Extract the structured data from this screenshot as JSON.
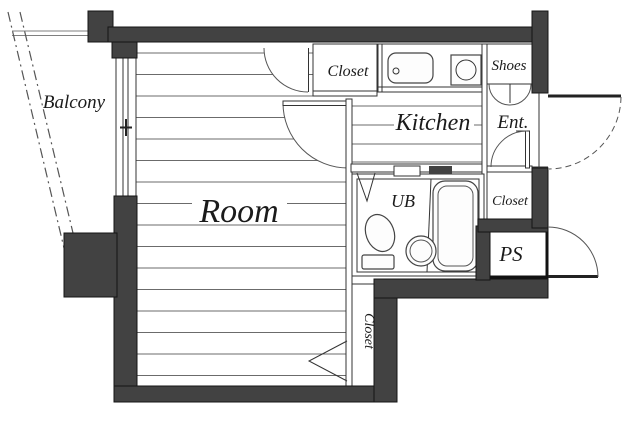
{
  "plan": {
    "type": "apartment-floor-plan",
    "labels": {
      "balcony": "Balcony",
      "room": "Room",
      "kitchen": "Kitchen",
      "closet_top": "Closet",
      "shoes": "Shoes",
      "entrance": "Ent.",
      "unit_bath": "UB",
      "closet_side": "Closet",
      "pipe_space": "PS",
      "closet_bottom": "Closet"
    },
    "colors": {
      "wall": "#424242",
      "wall_outline": "#141414",
      "thin_line": "#333333",
      "floor_line": "#6b6b6b",
      "background": "#ffffff"
    }
  }
}
